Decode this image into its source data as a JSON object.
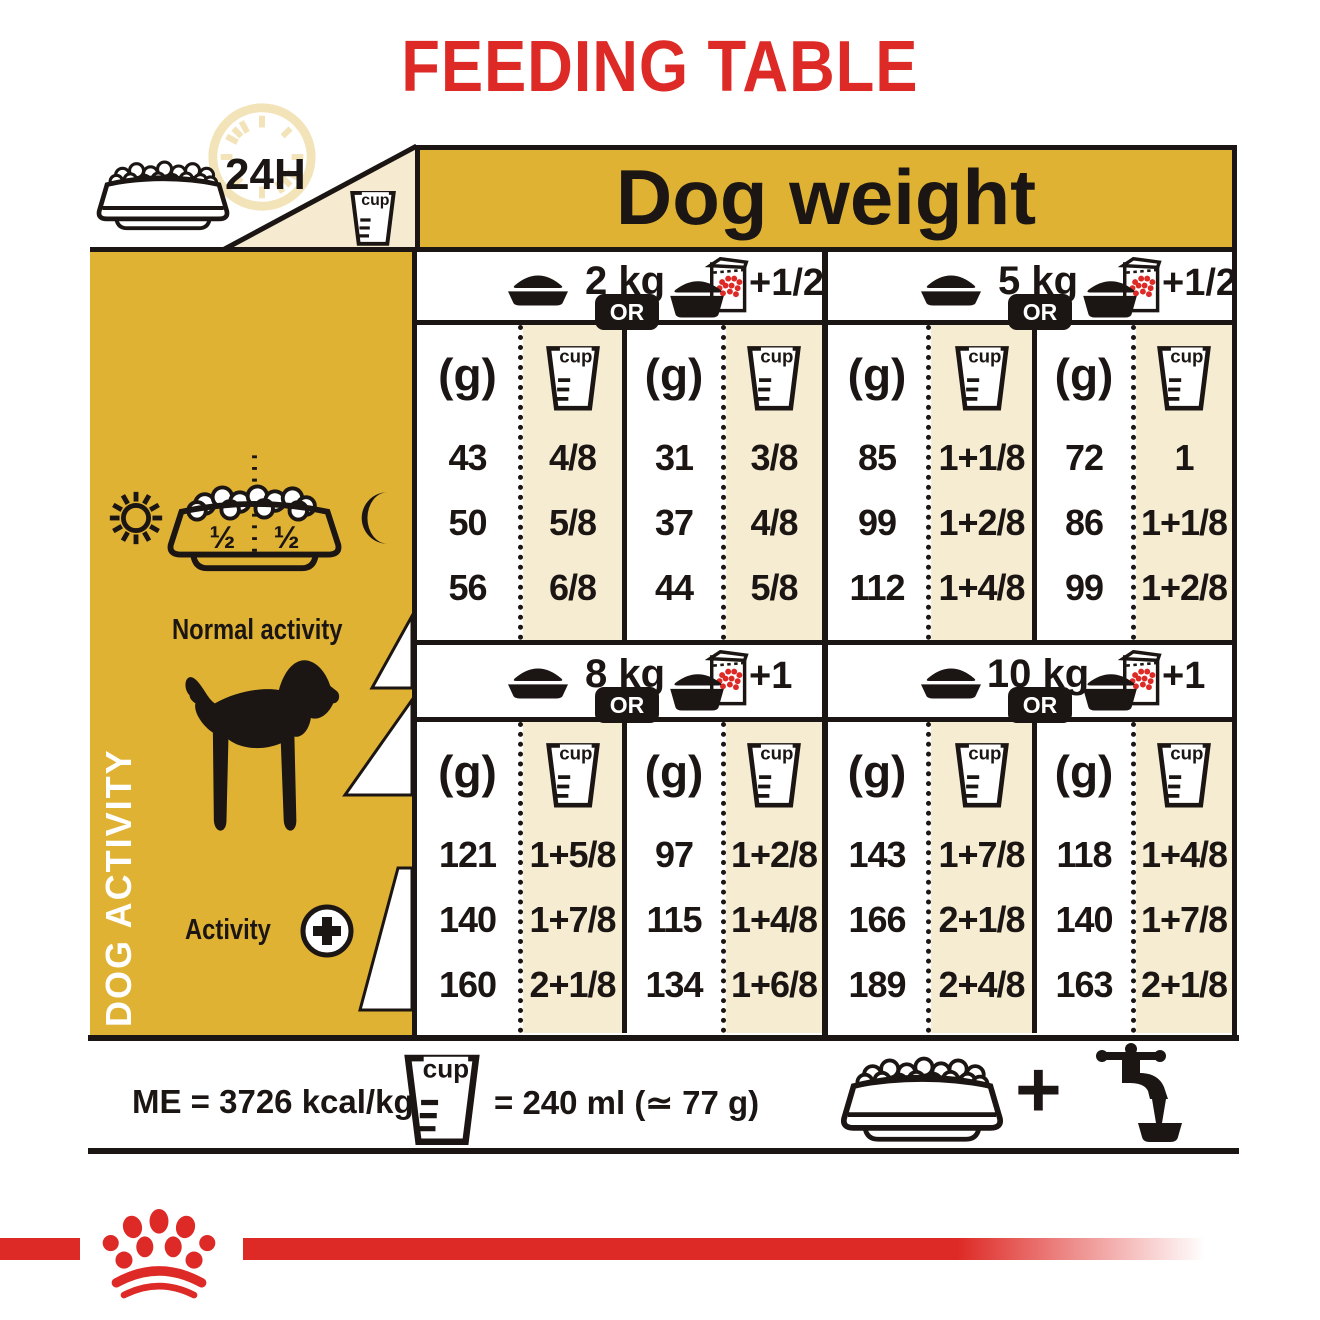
{
  "title": "FEEDING TABLE",
  "colors": {
    "gold": "#e0b233",
    "cream": "#f6ecd2",
    "red": "#de2a26",
    "black": "#1b1613"
  },
  "top_left": {
    "hours_label": "24H"
  },
  "header": {
    "dog_weight_label": "Dog weight"
  },
  "sidebar": {
    "dog_activity_label": "DOG ACTIVITY",
    "bowl_half_left": "½",
    "bowl_half_right": "½",
    "normal_activity_label": "Normal activity",
    "activity_label": "Activity"
  },
  "table": {
    "unit_label": "(g)",
    "cup_label": "cup",
    "or_label": "OR",
    "sections": [
      {
        "weight_label": "2 kg",
        "supplement_label": "+1/2",
        "dry": {
          "grams": [
            "43",
            "50",
            "56"
          ],
          "cups": [
            "4/8",
            "5/8",
            "6/8"
          ]
        },
        "mixed": {
          "grams": [
            "31",
            "37",
            "44"
          ],
          "cups": [
            "3/8",
            "4/8",
            "5/8"
          ]
        }
      },
      {
        "weight_label": "5 kg",
        "supplement_label": "+1/2",
        "dry": {
          "grams": [
            "85",
            "99",
            "112"
          ],
          "cups": [
            "1+1/8",
            "1+2/8",
            "1+4/8"
          ]
        },
        "mixed": {
          "grams": [
            "72",
            "86",
            "99"
          ],
          "cups": [
            "1",
            "1+1/8",
            "1+2/8"
          ]
        }
      },
      {
        "weight_label": "8 kg",
        "supplement_label": "+1",
        "dry": {
          "grams": [
            "121",
            "140",
            "160"
          ],
          "cups": [
            "1+5/8",
            "1+7/8",
            "2+1/8"
          ]
        },
        "mixed": {
          "grams": [
            "97",
            "115",
            "134"
          ],
          "cups": [
            "1+2/8",
            "1+4/8",
            "1+6/8"
          ]
        }
      },
      {
        "weight_label": "10 kg",
        "supplement_label": "+1",
        "dry": {
          "grams": [
            "143",
            "166",
            "189"
          ],
          "cups": [
            "1+7/8",
            "2+1/8",
            "2+4/8"
          ]
        },
        "mixed": {
          "grams": [
            "118",
            "140",
            "163"
          ],
          "cups": [
            "1+4/8",
            "1+7/8",
            "2+1/8"
          ]
        }
      }
    ]
  },
  "footer": {
    "me_label": "ME = 3726 kcal/kg",
    "cup_equiv_label": "= 240 ml (≃ 77 g)",
    "plus_label": "+"
  },
  "icons": {
    "clock_24h": "pale clock ring",
    "kibble_bowl": "outlined bowl with kibble",
    "measuring_cup": "measuring cup beaker",
    "food_bowl": "solid food bowl",
    "pouch_bowl": "wet food pouch over bowl",
    "sun": "sun",
    "moon": "crescent moon",
    "half_bowl": "bowl split half/half",
    "dachshund": "dachshund silhouette",
    "activity_plus": "plus in circle",
    "water_tap": "tap filling water bowl",
    "brand_crown": "red crown of dots"
  }
}
